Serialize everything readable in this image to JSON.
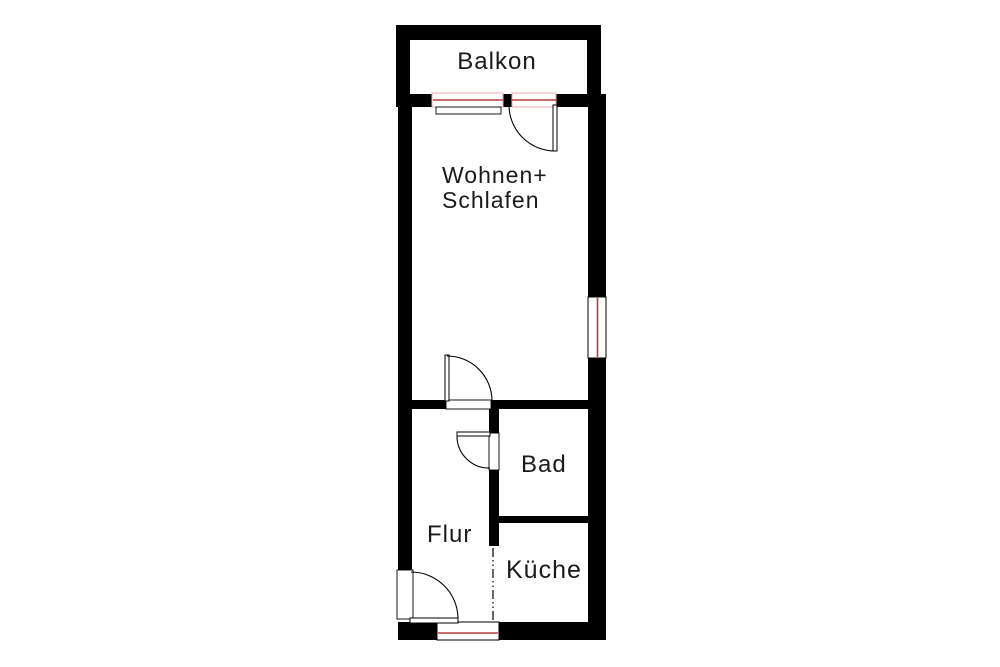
{
  "colors": {
    "background": "#ffffff",
    "wall": "#000000",
    "line": "#000000",
    "window_red": "#bb3a3a",
    "window_pink": "#f0a8b0",
    "text": "#1a1a1a"
  },
  "rooms": {
    "balkon": {
      "label": "Balkon"
    },
    "wohnen_schlafen": {
      "label_line1": "Wohnen+",
      "label_line2": "Schlafen"
    },
    "bad": {
      "label": "Bad"
    },
    "flur": {
      "label": "Flur"
    },
    "kueche": {
      "label": "Küche"
    }
  }
}
